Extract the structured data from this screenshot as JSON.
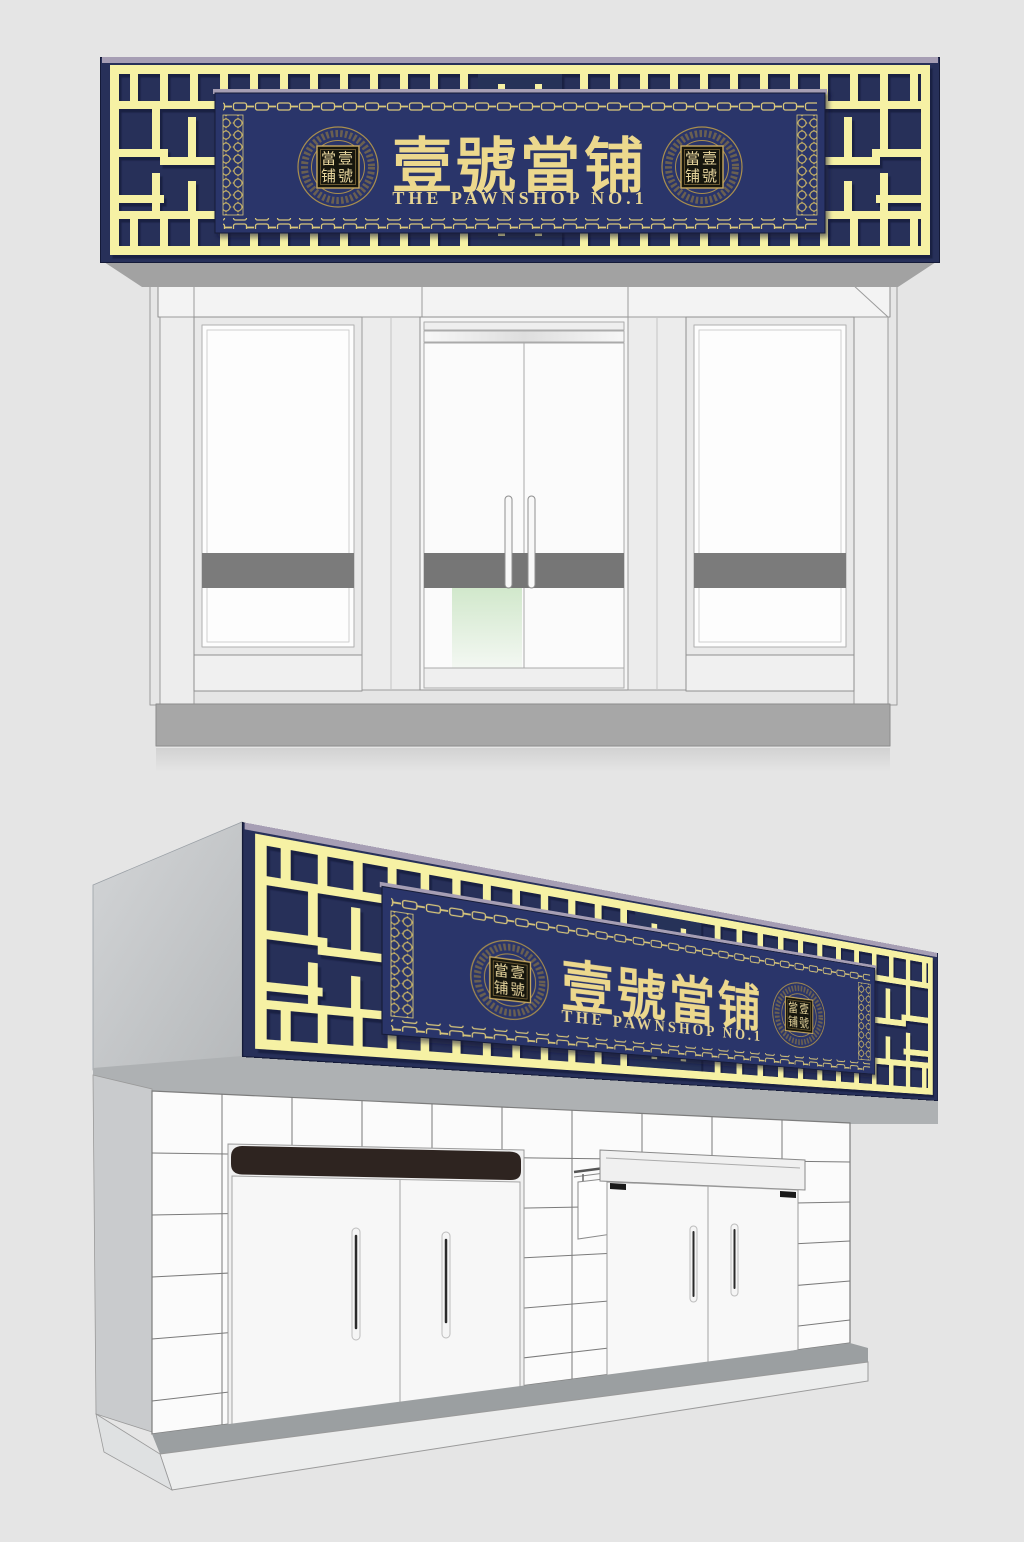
{
  "page": {
    "background": "#e5e5e5"
  },
  "sign": {
    "calligraphy": "壹號當铺",
    "english": "THE PAWNSHOP NO.1",
    "seal_row1": "當壹",
    "seal_row2": "铺號",
    "colors": {
      "board_navy": "#273059",
      "plaque_navy": "#2b356b",
      "lattice_yellow": "#f6f1a4",
      "calligraphy_gold": "#ecd88d",
      "english_gold": "#e6d493",
      "chain_gold": "#d9c77a",
      "medallion_gold": "#a88e4e",
      "seal_background": "#16120e",
      "top_edge_lavender": "#a69eb4"
    }
  },
  "storefront": {
    "colors": {
      "entrance_header_brown": "#2e2420",
      "tile_white": "#fbfbfb",
      "spandrel_band_gray": "#7b7b7b",
      "plinth_gray": "#a7a7a7",
      "side_wall_gray": "#c9cbcd"
    }
  }
}
